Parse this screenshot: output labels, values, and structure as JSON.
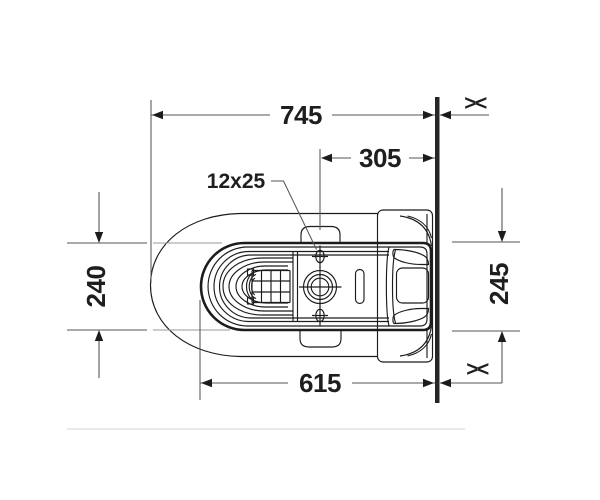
{
  "drawing": {
    "kind": "plan-view-dimension-drawing",
    "labels": {
      "overall_depth": "745",
      "rear_offset": "305",
      "hole_spec": "12x25",
      "front_width": "240",
      "rear_width": "245",
      "body_depth": "615",
      "wall_break_top": "><",
      "wall_break_bottom": "><"
    },
    "colors": {
      "background": "#ffffff",
      "drawing_line": "#1c1c1c",
      "dimension_line": "#565656",
      "text": "#1e1e1e",
      "wall": "#262626",
      "floor_baseline": "#e9e9e9"
    }
  }
}
